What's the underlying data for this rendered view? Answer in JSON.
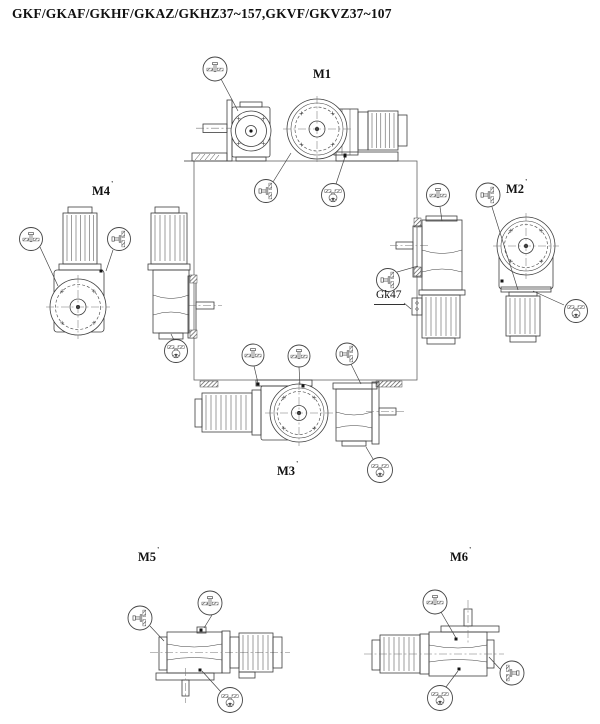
{
  "page": {
    "title": "GKF/GKAF/GKHF/GKAZ/GKHZ37~157,GKVF/GKVZ37~107"
  },
  "positions": {
    "m1": {
      "label": "M1",
      "sup": ""
    },
    "m2": {
      "label": "M2",
      "sup": "'"
    },
    "m3": {
      "label": "M3",
      "sup": "'"
    },
    "m4": {
      "label": "M4",
      "sup": "'"
    },
    "m5": {
      "label": "M5",
      "sup": "'"
    },
    "m6": {
      "label": "M6",
      "sup": "'"
    }
  },
  "callouts": {
    "gk47": "Gk47",
    "oil_level_icon": "oil-level-plug",
    "oil_fill_icon": "oil-fill-plug",
    "oil_drain_icon": "oil-drain-plug"
  },
  "colors": {
    "line": "#3d3d3d",
    "text": "#111111",
    "background": "#ffffff"
  }
}
